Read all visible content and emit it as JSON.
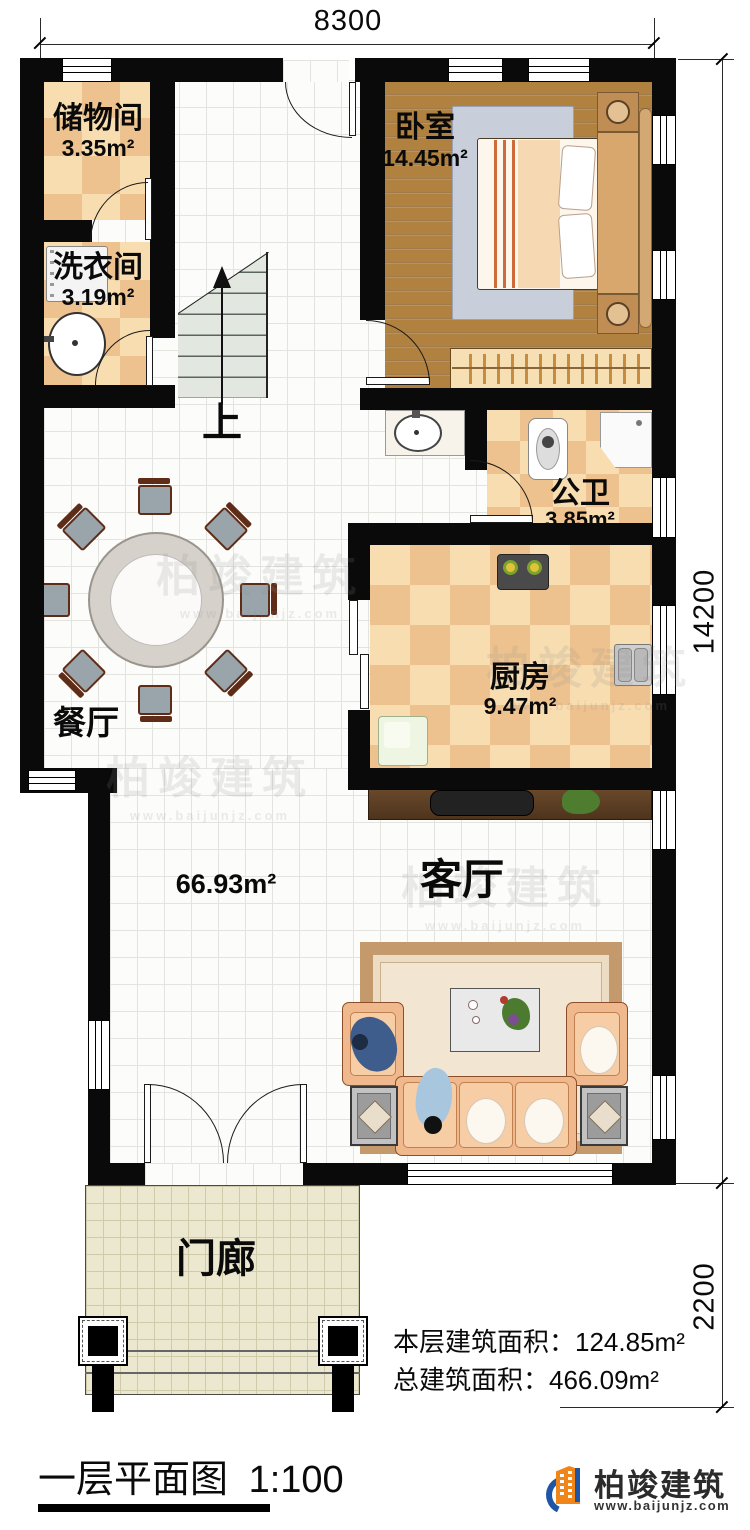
{
  "dimensions": {
    "width_top": "8300",
    "height_main": "14200",
    "height_porch": "2200"
  },
  "rooms": {
    "storage": {
      "name": "储物间",
      "area": "3.35m²"
    },
    "laundry": {
      "name": "洗衣间",
      "area": "3.19m²"
    },
    "bedroom": {
      "name": "卧室",
      "area": "14.45m²"
    },
    "bathroom": {
      "name": "公卫",
      "area": "3.85m²"
    },
    "kitchen": {
      "name": "厨房",
      "area": "9.47m²"
    },
    "dining": {
      "name": "餐厅"
    },
    "living": {
      "name": "客厅",
      "area": "66.93m²"
    },
    "porch": {
      "name": "门廊"
    },
    "stairs": {
      "direction": "上"
    }
  },
  "summary": {
    "floor": {
      "label": "本层建筑面积：",
      "value": "124.85m²"
    },
    "total": {
      "label": "总建筑面积：",
      "value": "466.09m²"
    }
  },
  "footer": {
    "title": "一层平面图",
    "scale": "1:100"
  },
  "brand": {
    "name": "柏竣建筑",
    "website": "www.baijunjz.com"
  },
  "colors": {
    "wall": "#0a0a0a",
    "checker_light": "#f8ddb0",
    "checker_dark": "#eec28e",
    "wood": "#b0813f",
    "logo_blue": "#1f55a5",
    "logo_orange": "#f08519"
  }
}
